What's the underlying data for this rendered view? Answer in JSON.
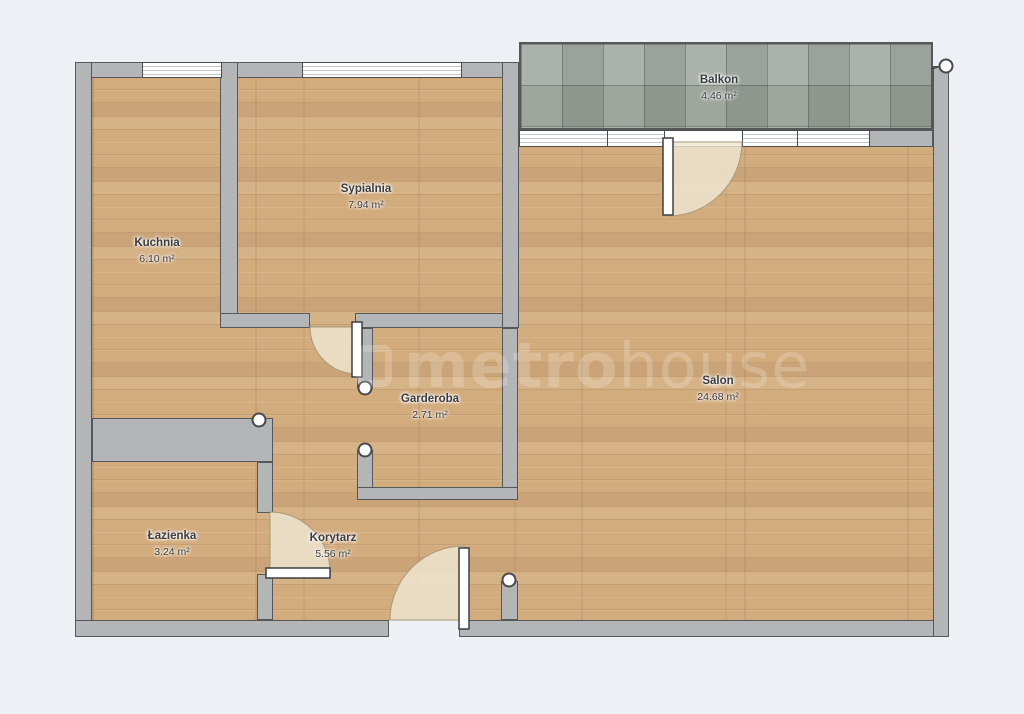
{
  "plan_title": "apartment-floor-plan",
  "rooms": [
    {
      "id": "balkon",
      "name": "Balkon",
      "area": "4.46 m²"
    },
    {
      "id": "sypialnia",
      "name": "Sypialnia",
      "area": "7.94 m²"
    },
    {
      "id": "kuchnia",
      "name": "Kuchnia",
      "area": "6.10 m²"
    },
    {
      "id": "salon",
      "name": "Salon",
      "area": "24.68 m²"
    },
    {
      "id": "garderoba",
      "name": "Garderoba",
      "area": "2.71 m²"
    },
    {
      "id": "lazienka",
      "name": "Łazienka",
      "area": "3.24 m²"
    },
    {
      "id": "korytarz",
      "name": "Korytarz",
      "area": "5.56 m²"
    }
  ],
  "watermark": {
    "bold": "metro",
    "light": "house"
  },
  "colors": {
    "background": "#eef0f6",
    "wall": "#b3b5b7",
    "wall_outline": "#55585a",
    "wood_floor": "#d3ac7e",
    "balcony_tile": "#9fa79f",
    "door_swing": "#efe5d2"
  }
}
